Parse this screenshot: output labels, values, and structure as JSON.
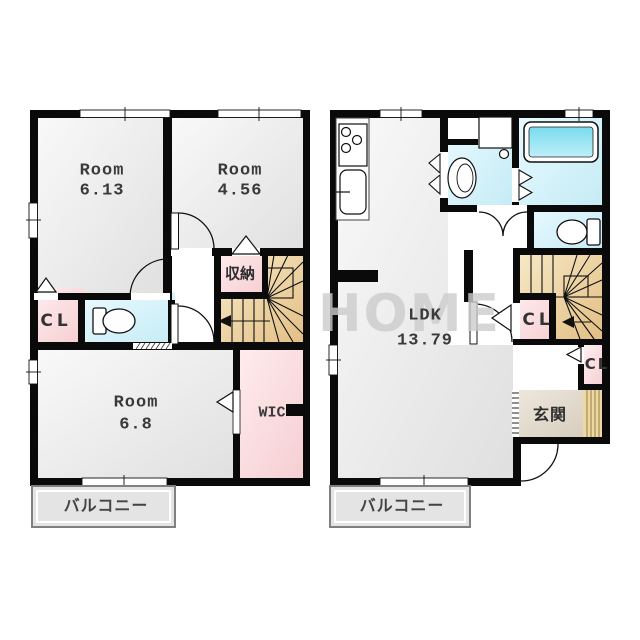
{
  "plans": {
    "second_floor": {
      "room_613": {
        "name": "Room",
        "area": "6.13"
      },
      "room_456": {
        "name": "Room",
        "area": "4.56"
      },
      "storage": "収納",
      "closet": "CL",
      "room_68": {
        "name": "Room",
        "area": "6.8"
      },
      "wic": "WIC",
      "balcony": "バルコニー"
    },
    "first_floor": {
      "ldk": {
        "name": "LDK",
        "area": "13.79"
      },
      "closet_hall": "CL",
      "closet_entry": "CL",
      "entrance": "玄関",
      "balcony": "バルコニー"
    }
  },
  "watermark": "HOME",
  "colors": {
    "wall": "#0a0a0a",
    "floor_light": "#fafafa",
    "floor_dark": "#dfdfdf",
    "pink_light": "#ffeef0",
    "pink_dark": "#f5ccd0",
    "cyan_light": "#eafaff",
    "cyan_dark": "#c4ebf5",
    "tub_light": "#bdeff8",
    "tub_dark": "#7adbee",
    "stairs_light": "#f8ecca",
    "stairs_dark": "#e2bd82",
    "genkan_light": "#eee8de",
    "genkan_dark": "#d7cdbd",
    "balcony": "#e4e4e4",
    "porch": "#ecd9a4"
  }
}
